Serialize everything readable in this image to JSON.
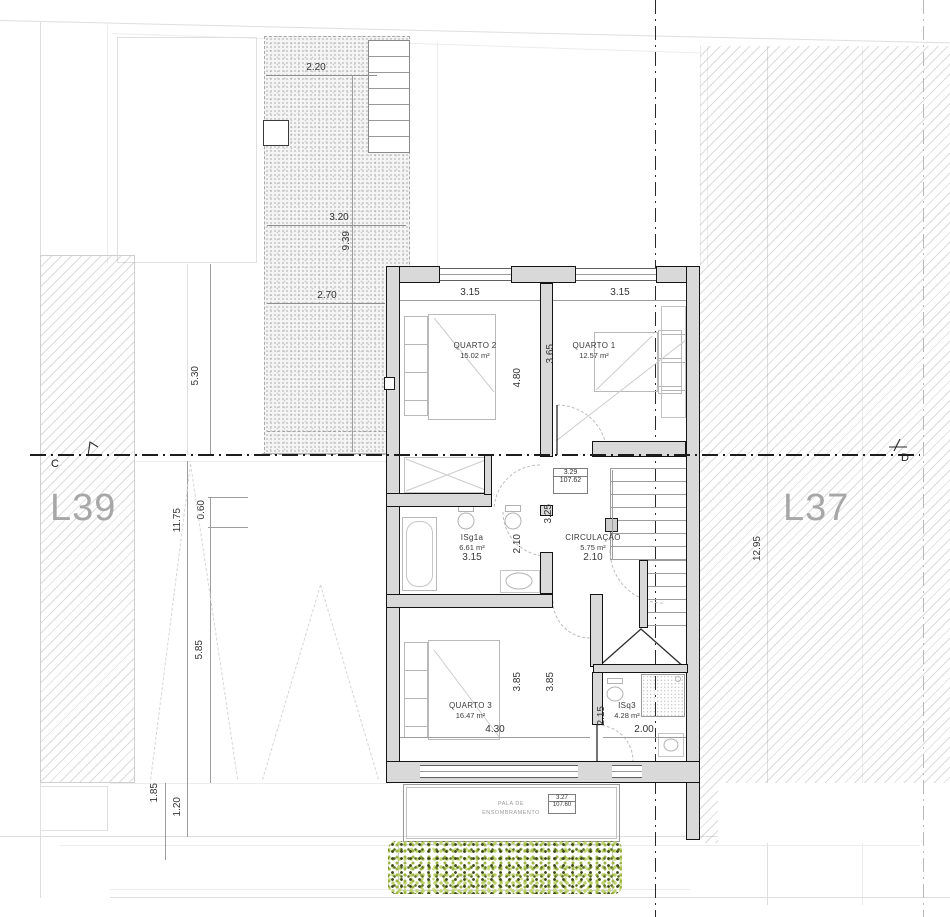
{
  "lots": {
    "left": "L39",
    "right": "L37"
  },
  "section": {
    "left": "C",
    "right": "D"
  },
  "rooms": {
    "quarto2": {
      "name": "QUARTO 2",
      "area": "15.02 m²",
      "width": "3.15",
      "depth": "4.80"
    },
    "quarto1": {
      "name": "QUARTO 1",
      "area": "12.57 m²",
      "width": "3.15",
      "depth": "3.65"
    },
    "isg1a": {
      "name": "ISg1a",
      "area": "6.61 m²",
      "width": "3.15",
      "depth": "2.10"
    },
    "circulacao": {
      "name": "CIRCULAÇÃO",
      "area": "5.75 m²",
      "width": "2.10",
      "depth": "3.25"
    },
    "quarto3": {
      "name": "QUARTO 3",
      "area": "16.47 m²",
      "width": "4.30",
      "depth_left": "3.85",
      "depth_right": "3.85"
    },
    "isq3": {
      "name": "ISq3",
      "area": "4.28 m²",
      "width": "2.00",
      "depth": "2.15"
    }
  },
  "terrace": {
    "width_top": "2.20",
    "width_mid": "3.20",
    "depth": "9.39",
    "width_low": "2.70"
  },
  "site": {
    "d530": "5.30",
    "d1175": "11.75",
    "d060": "0.60",
    "d585": "5.85",
    "d185": "1.85",
    "d120": "1.20",
    "d1295": "12.95"
  },
  "levels": {
    "floor": {
      "h": "3.29",
      "alt": "107.62"
    },
    "canopy": {
      "h": "3.27",
      "alt": "107.60"
    }
  },
  "canopy": {
    "line1": "PALA DE",
    "line2": "ENSOMBRAMENTO"
  },
  "colors": {
    "wall_fill": "#d9d9d9",
    "wall_edge": "#141414",
    "lot_label": "#a7a7a7",
    "hedge_light": "#bdd36e",
    "hedge_dark": "#3c481c"
  }
}
